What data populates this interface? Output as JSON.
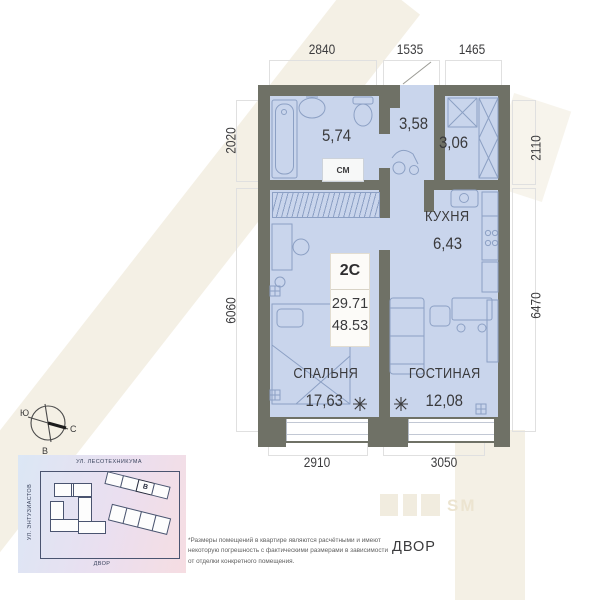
{
  "plan": {
    "unit_badge": {
      "type": "2С",
      "living_area": "29.71",
      "total_area": "48.53"
    },
    "rooms": [
      {
        "name": "",
        "area": "5,74"
      },
      {
        "name": "",
        "area": "3,58"
      },
      {
        "name": "",
        "area": "3,06"
      },
      {
        "name": "КУХНЯ",
        "area": "6,43"
      },
      {
        "name": "СПАЛЬНЯ",
        "area": "17,63"
      },
      {
        "name": "ГОСТИНАЯ",
        "area": "12,08"
      }
    ],
    "labels": {
      "washing_machine": "СМ"
    },
    "dimensions": {
      "top": [
        "2840",
        "1535",
        "1465"
      ],
      "left": [
        "2020",
        "6060"
      ],
      "right": [
        "2110",
        "6470"
      ],
      "bottom": [
        "2910",
        "3050"
      ]
    }
  },
  "compass": {
    "south": "Ю",
    "north": "С",
    "east": "В"
  },
  "minimap": {
    "street_top": "УЛ. ЛЕСОТЕХНИКУМА",
    "street_left": "УЛ. ЭНТУЗИАСТОВ",
    "yard_label": "ДВОР",
    "building_label": "В"
  },
  "yard_label": "ДВОР",
  "footnote": "*Размеры помещений в квартире являются расчётными и имеют некоторую погрешность с фактическими размерами в зависимости от отделки конкретного помещения.",
  "watermark": "SM",
  "colors": {
    "wall": "#6f7166",
    "floor": "#c9d5ec",
    "furniture": "#8ca0c4",
    "watermark": "#f1ecdf"
  }
}
